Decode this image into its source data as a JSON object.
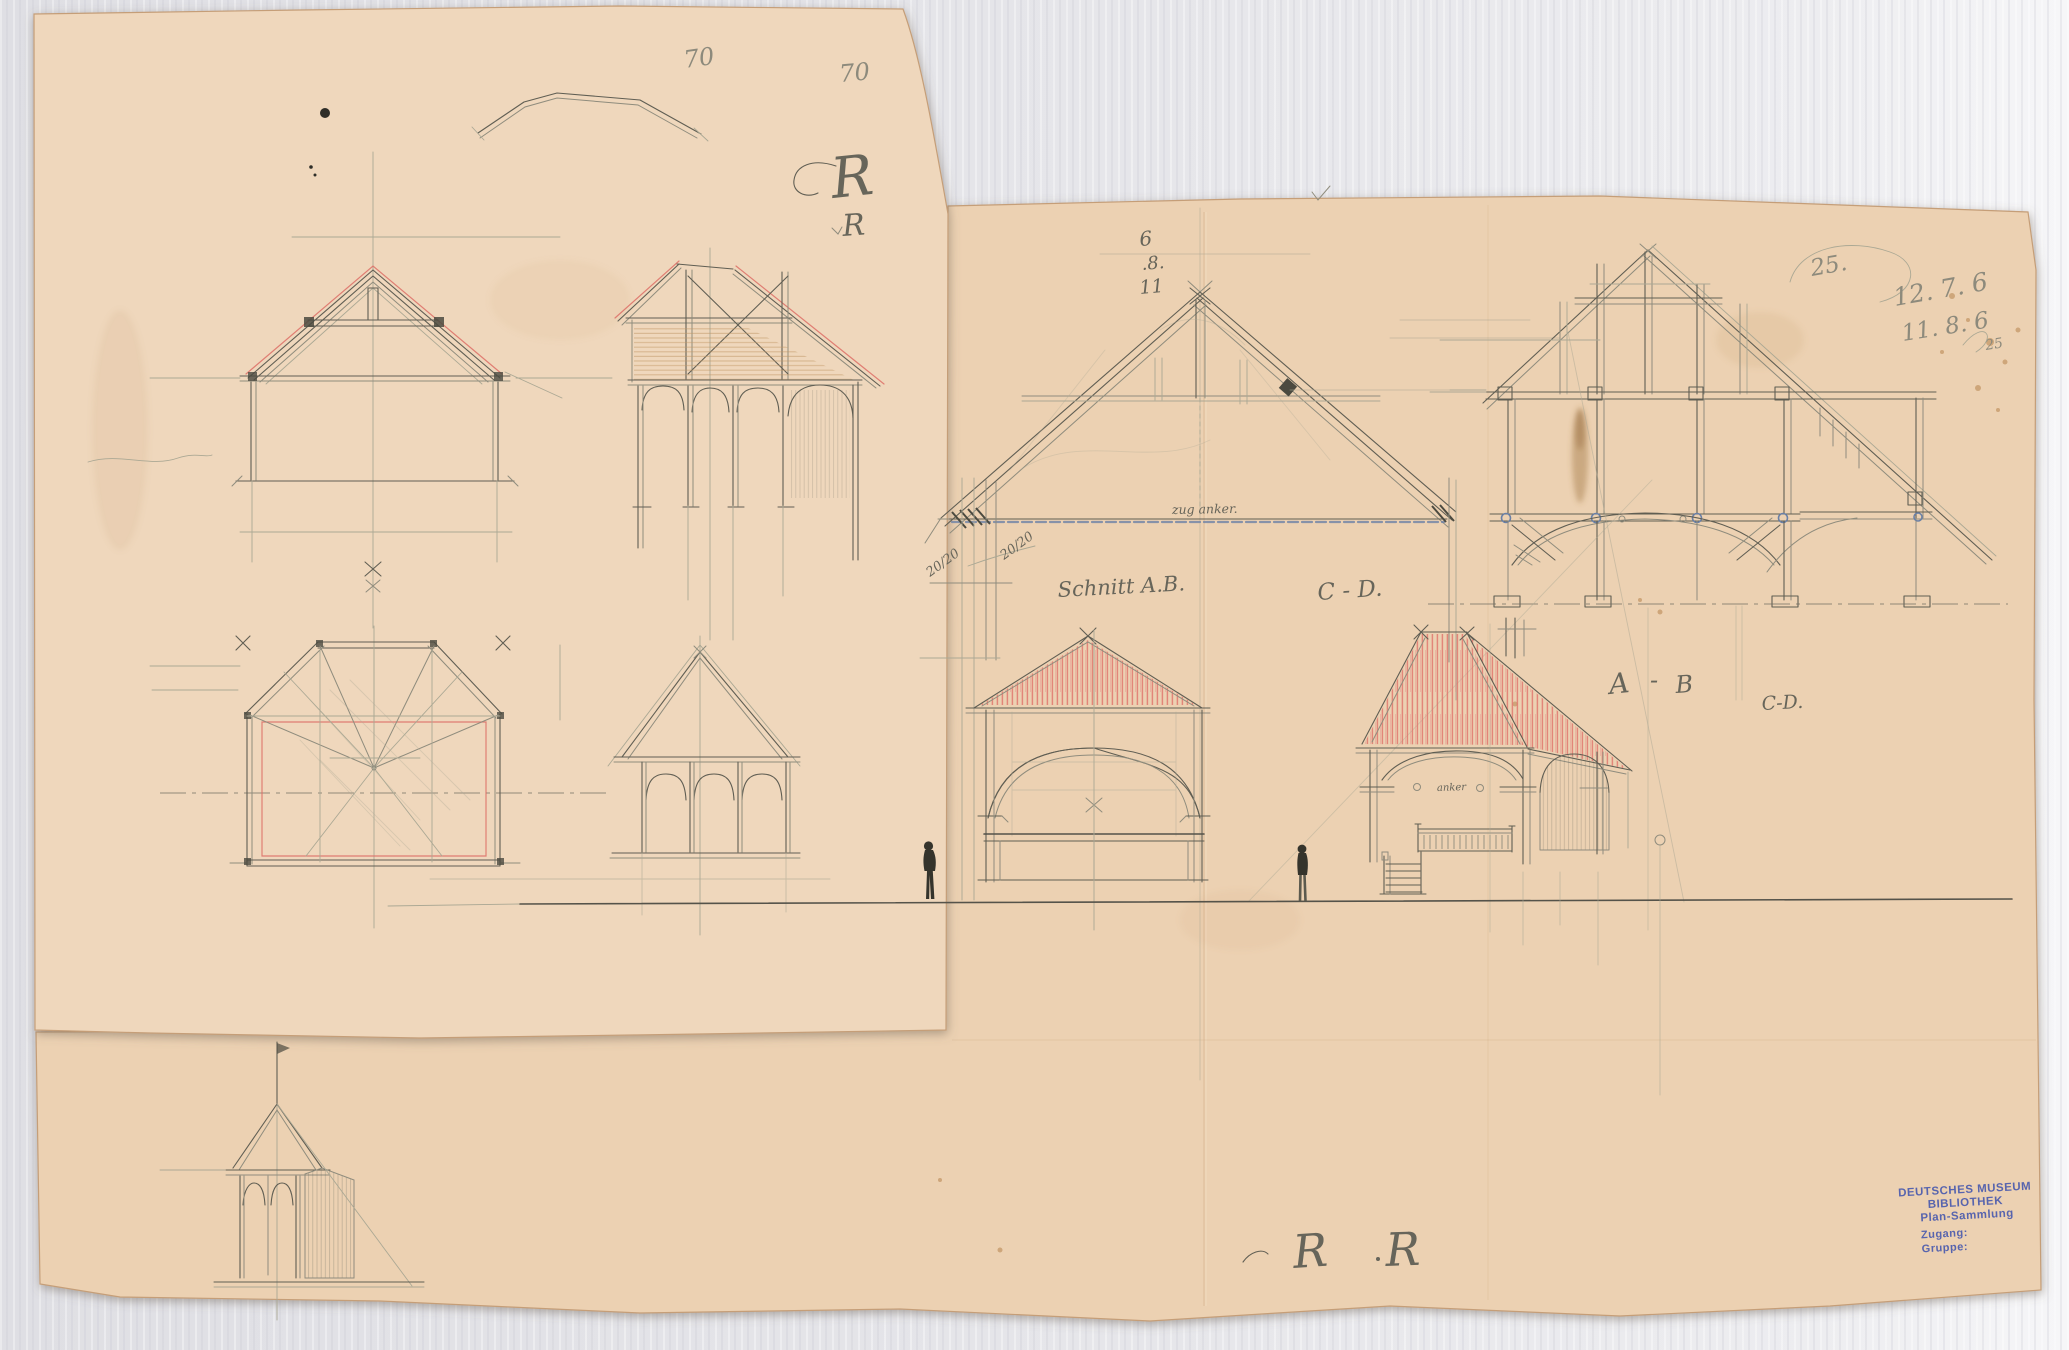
{
  "colors": {
    "background": "#e6e6ea",
    "paper_left_sheet": "#efd7bc",
    "paper_right_sheet": "#ecd1b2",
    "pencil": "#605e53",
    "red_crayon": "#dd6f66",
    "blue_ink": "#6a80a6",
    "stamp_blue": "#4355ad"
  },
  "annotations": {
    "dim_top_left": "70",
    "dim_top_right": "70",
    "monogram_large": "R",
    "monogram_small": "R",
    "date_stack": [
      "6",
      ".8.",
      "11"
    ],
    "circled_value": "25.",
    "pencil_note_line1": "12. 7. 6",
    "pencil_note_line2": "11. 8. 6",
    "pencil_note_line2_suffix": "25",
    "section_label_ab": "Schnitt A.B.",
    "section_label_cd": "C - D.",
    "tie_rod_label": "zug anker.",
    "timber_dim_left": "20/20",
    "timber_dim_right": "20/20",
    "marker_a": "A",
    "marker_dash": "-",
    "marker_b": "B",
    "marker_cd_small": "C-D.",
    "anchor_label": "anker",
    "signature_left": "R",
    "signature_right": "R"
  },
  "stamp": {
    "line1": "DEUTSCHES MUSEUM",
    "line2": "BIBLIOTHEK",
    "line3": "Plan-Sammlung",
    "line4": "Zugang:",
    "line5": "Gruppe:"
  }
}
